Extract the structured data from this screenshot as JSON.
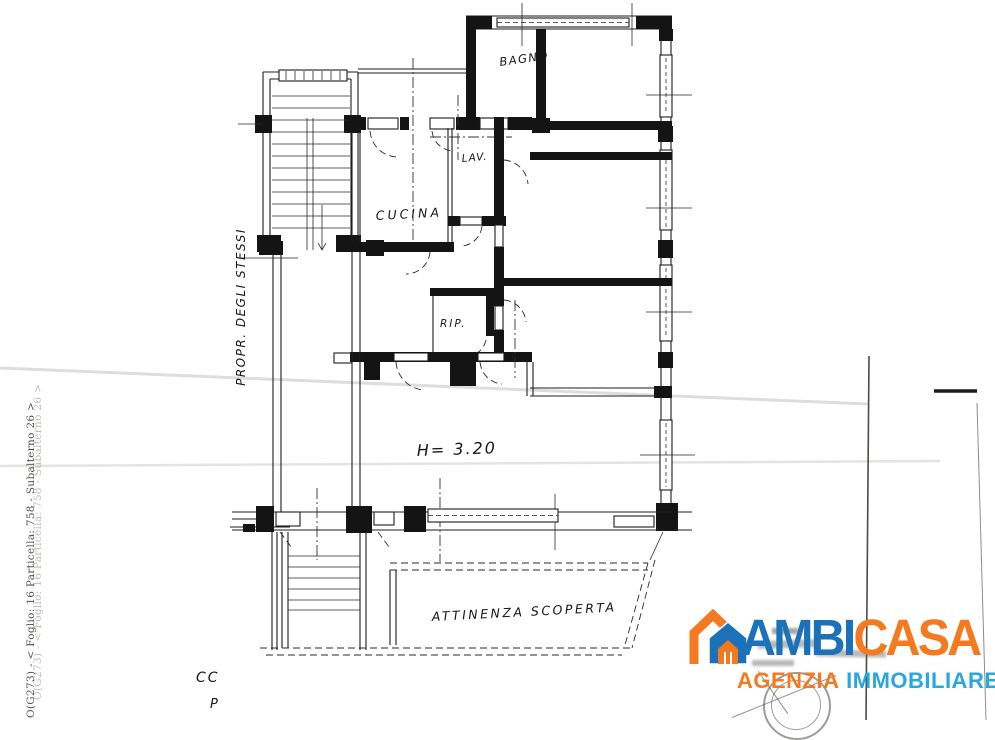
{
  "plan": {
    "rooms": {
      "bagno": "BAGNO",
      "cucina": "CUCINA",
      "lav": "LAV.",
      "rip": "RIP."
    },
    "annotations": {
      "ceiling_height": "H= 3.20",
      "yard": "ATTINENZA SCOPERTA",
      "ownership": "PROPR. DEGLI STESSI",
      "corner_top": "CC",
      "corner_bottom": "P"
    },
    "cadastral_note": "O(G273) - < Foglio: 16 Particella: 758 - Subalterno 26 >",
    "ink_color": "#1a1a1a"
  },
  "logo": {
    "brand_left": "AMBI",
    "brand_right": "CASA",
    "tagline_left": "AGENZIA",
    "tagline_right": "IMMOBILIARE",
    "colors": {
      "blue": "#1b72b8",
      "light_blue": "#2aa7dc",
      "orange": "#f4791f"
    }
  }
}
